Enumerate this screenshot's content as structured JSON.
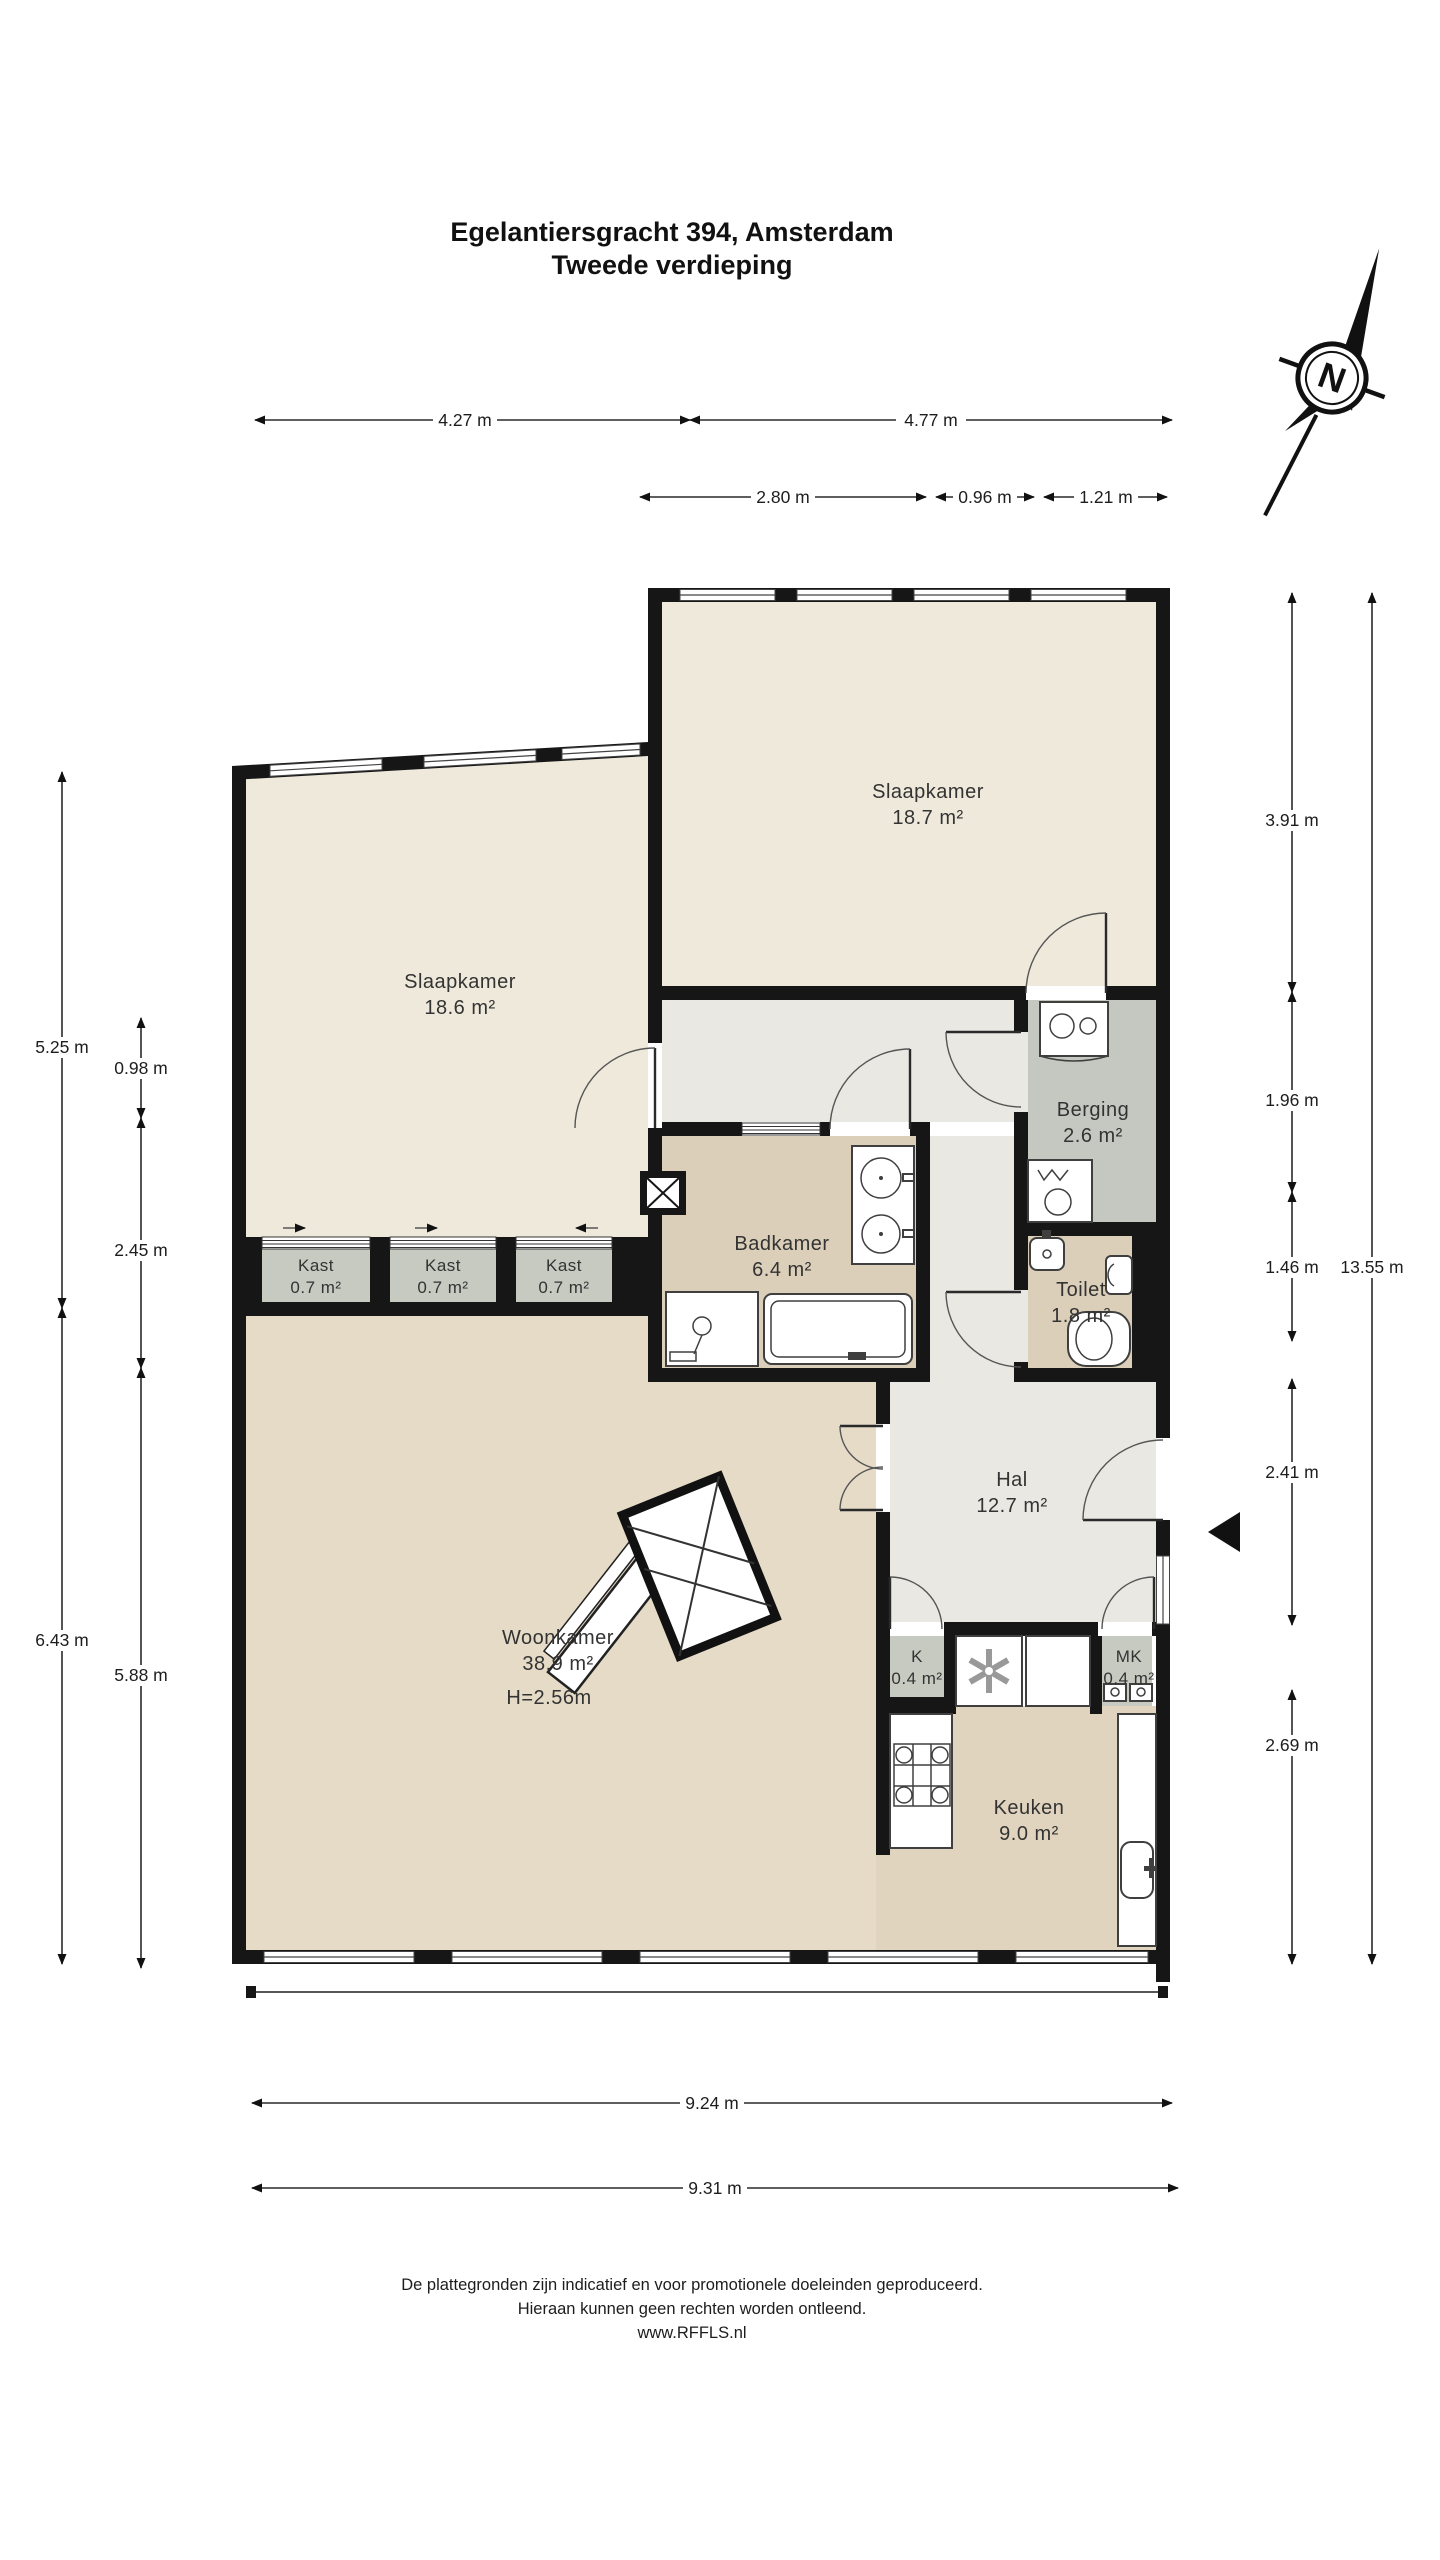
{
  "title": {
    "line1": "Egelantiersgracht 394, Amsterdam",
    "line2": "Tweede verdieping"
  },
  "compass": {
    "letter": "N"
  },
  "rooms": {
    "slaapkamer_1": {
      "name": "Slaapkamer",
      "area": "18.7 m²"
    },
    "slaapkamer_2": {
      "name": "Slaapkamer",
      "area": "18.6 m²"
    },
    "berging": {
      "name": "Berging",
      "area": "2.6 m²"
    },
    "badkamer": {
      "name": "Badkamer",
      "area": "6.4 m²"
    },
    "toilet": {
      "name": "Toilet",
      "area": "1.8 m²"
    },
    "hal": {
      "name": "Hal",
      "area": "12.7 m²"
    },
    "woonkamer": {
      "name": "Woonkamer",
      "area": "38.9 m²",
      "height": "H=2.56m"
    },
    "keuken": {
      "name": "Keuken",
      "area": "9.0 m²"
    },
    "kast_1": {
      "name": "Kast",
      "area": "0.7 m²"
    },
    "kast_2": {
      "name": "Kast",
      "area": "0.7 m²"
    },
    "kast_3": {
      "name": "Kast",
      "area": "0.7 m²"
    },
    "k": {
      "name": "K",
      "area": "0.4 m²"
    },
    "mk": {
      "name": "MK",
      "area": "0.4 m²"
    }
  },
  "dimensions": {
    "top_row1": [
      {
        "label": "4.27 m"
      },
      {
        "label": "4.77 m"
      }
    ],
    "top_row2": [
      {
        "label": "2.80 m"
      },
      {
        "label": "0.96 m"
      },
      {
        "label": "1.21 m"
      }
    ],
    "right": [
      {
        "label": "3.91 m"
      },
      {
        "label": "1.96 m"
      },
      {
        "label": "1.46 m"
      },
      {
        "label": "2.41 m"
      },
      {
        "label": "2.69 m"
      }
    ],
    "right_total": {
      "label": "13.55 m"
    },
    "left_outer": [
      {
        "label": "5.25 m"
      },
      {
        "label": "6.43 m"
      }
    ],
    "left_inner": [
      {
        "label": "0.98 m"
      },
      {
        "label": "2.45 m"
      },
      {
        "label": "5.88 m"
      }
    ],
    "bottom": [
      {
        "label": "9.24 m"
      },
      {
        "label": "9.31 m"
      }
    ]
  },
  "footer": {
    "line1": "De plattegronden zijn indicatief en voor promotionele doeleinden geproduceerd.",
    "line2": "Hieraan kunnen geen rechten worden ontleend.",
    "line3": "www.RFFLS.nl"
  },
  "colors": {
    "wall": "#161616",
    "bedroom": "#eee9db",
    "hal": "#e9e8e2",
    "bath": "#dccfba",
    "living": "#e5dbc7",
    "kitchen": "#e0d4bf",
    "closet": "#c7cac1",
    "storage": "#c5c8c0",
    "white": "#ffffff"
  }
}
